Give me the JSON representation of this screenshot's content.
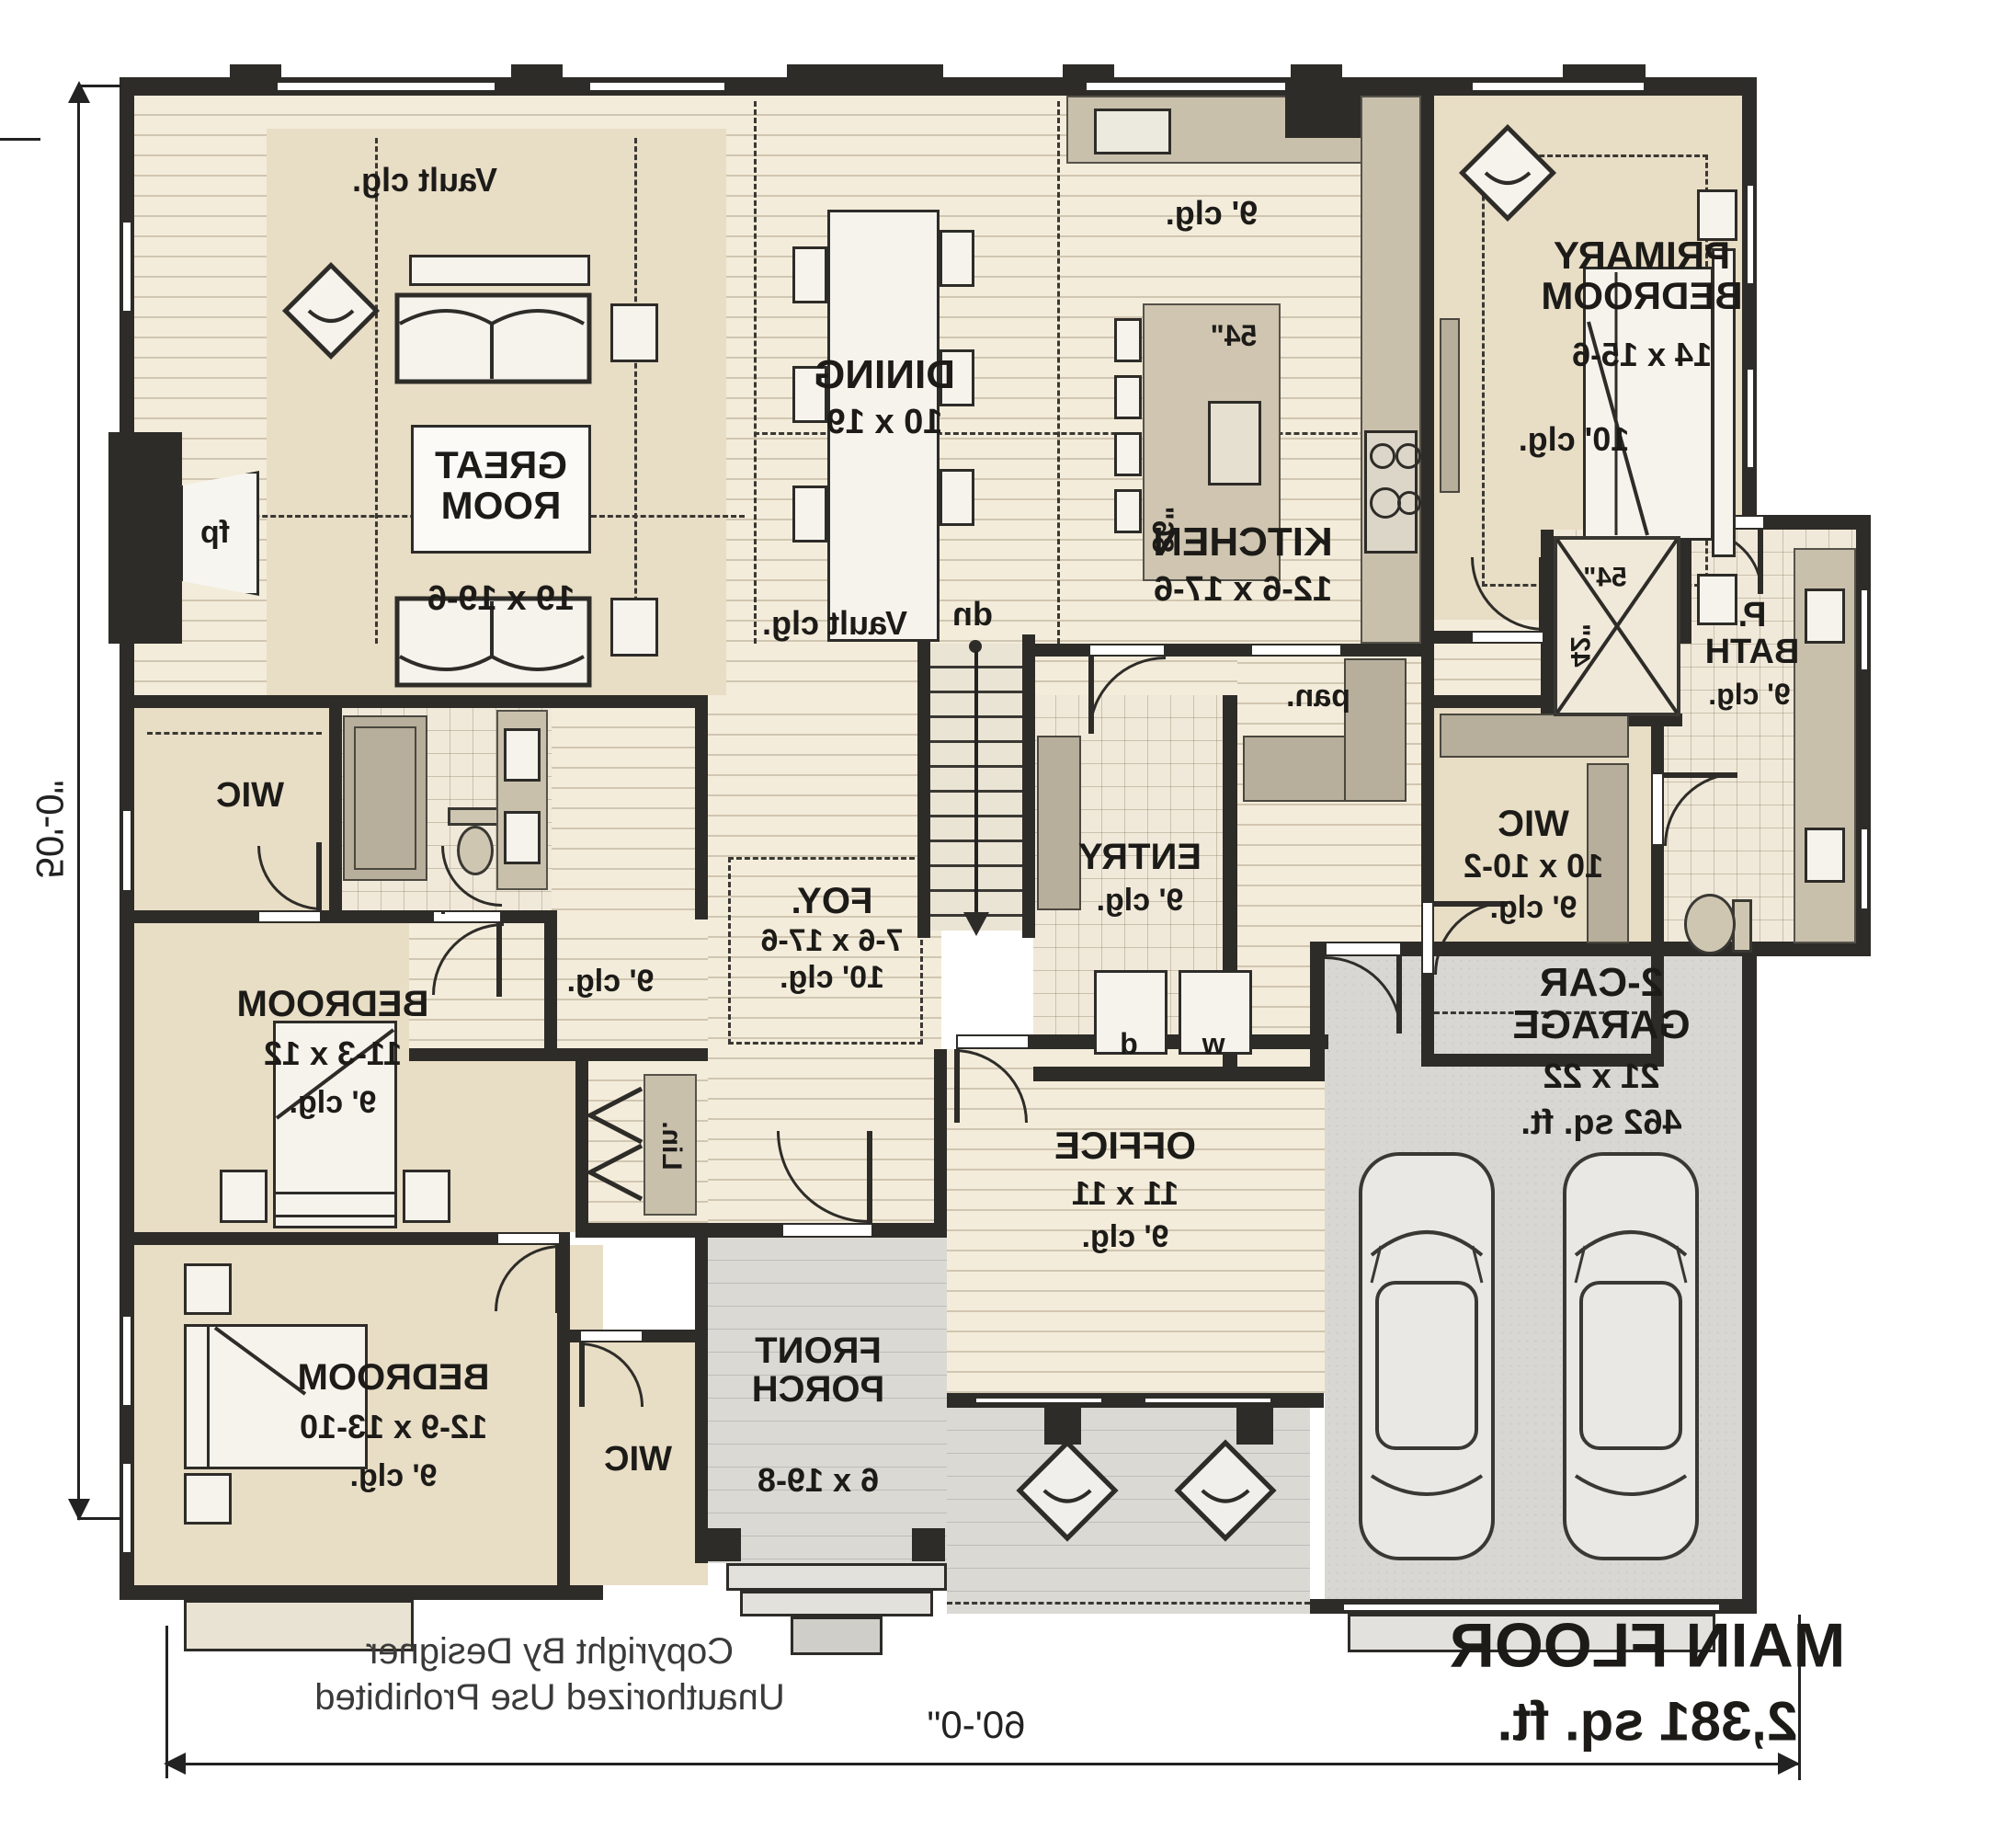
{
  "plan": {
    "title": "MAIN FLOOR",
    "area": "2,381 sq. ft.",
    "width_dim": "60'-0\"",
    "height_dim": "50'-0\"",
    "copyright_line1": "Copyright By Designer",
    "copyright_line2": "Unauthorized Use Prohibited",
    "orientation_note": "plan rendered mirrored (flipped reading)"
  },
  "rooms": {
    "great_room": {
      "name": "GREAT ROOM",
      "dims": "19 x 19-6",
      "ceiling": "Vault clg."
    },
    "dining": {
      "name": "DINING",
      "dims": "10 x 19"
    },
    "kitchen": {
      "name": "KITCHEN",
      "dims": "12-6 x 17-6",
      "ceiling": "9' clg.",
      "island_width": "54\"",
      "island_length": "86\"",
      "pantry": "pan."
    },
    "primary_bedroom": {
      "name": "PRIMARY BEDROOM",
      "dims": "14 x 15-6",
      "ceiling": "10' clg."
    },
    "primary_bath": {
      "name": "P. BATH",
      "ceiling": "9' clg.",
      "shower_width": "54\"",
      "shower_depth": "42\""
    },
    "primary_wic": {
      "name": "WIC",
      "dims": "10 x 10-2",
      "ceiling": "9' clg."
    },
    "entry": {
      "name": "ENTRY",
      "ceiling": "9' clg.",
      "washer": "w",
      "dryer": "d"
    },
    "foyer": {
      "name": "FOY.",
      "dims": "7-6 x 17-6",
      "ceiling": "10' clg.",
      "hall_ceiling": "Vault clg."
    },
    "hall": {
      "ceiling": "9' clg."
    },
    "stairs": {
      "label": "dn"
    },
    "linen": {
      "name": "Lin."
    },
    "office": {
      "name": "OFFICE",
      "dims": "11 x 11",
      "ceiling": "9' clg."
    },
    "front_porch": {
      "name": "FRONT PORCH",
      "dims": "6 x 19-8"
    },
    "garage": {
      "name": "2-CAR GARAGE",
      "dims": "21 x 22",
      "area": "462 sq. ft."
    },
    "bedroom_2": {
      "name": "BEDROOM",
      "dims": "11-3 x 12",
      "ceiling": "9' clg.",
      "closet": "WIC"
    },
    "bedroom_3": {
      "name": "BEDROOM",
      "dims": "12-9 x 13-10",
      "ceiling": "9' clg.",
      "closet": "WIC"
    },
    "fireplace": {
      "label": "fp"
    }
  },
  "colors": {
    "wall": "#2e2c28",
    "wood_floor": "#f3ecda",
    "carpet": "#e8ddc5",
    "tile": "#f0e9d9",
    "garage_floor": "#d8d7d3",
    "porch_floor": "#dbd9d4",
    "cabinet": "#c9c0ac",
    "text": "#1c1b18"
  }
}
